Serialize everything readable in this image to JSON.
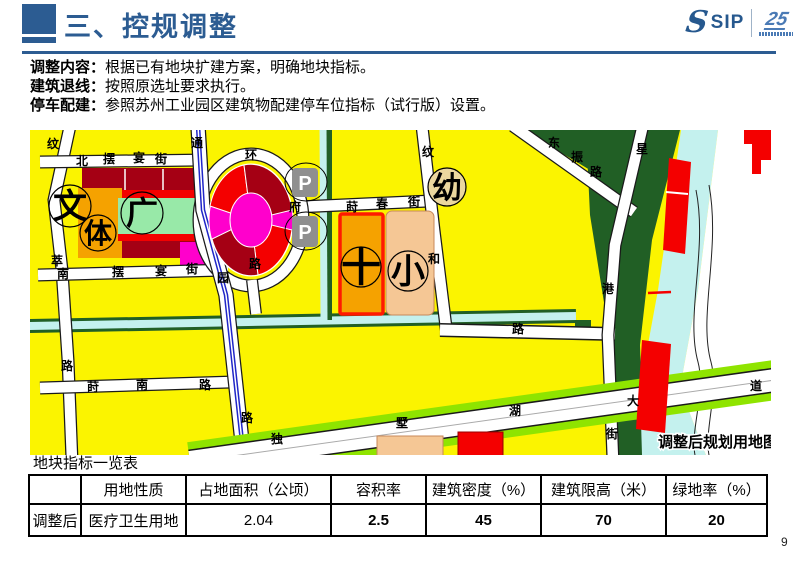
{
  "header": {
    "title": "三、控规调整",
    "logo_s": "S",
    "logo_sip": "SIP",
    "logo_anniv": "25"
  },
  "intro": [
    {
      "label": "调整内容：",
      "text": "根据已有地块扩建方案，明确地块指标。"
    },
    {
      "label": "建筑退线：",
      "text": "按照原选址要求执行。"
    },
    {
      "label": "停车配建：",
      "text": "参照苏州工业园区建筑物配建停车位指标（试行版）设置。"
    }
  ],
  "map": {
    "caption": "调整后规划用地图",
    "street_chars": [
      "纹",
      "北",
      "摆",
      "宴",
      "街",
      "通",
      "萃",
      "南",
      "摆",
      "宴",
      "街",
      "园",
      "路",
      "路",
      "环",
      "路",
      "府",
      "莳",
      "春",
      "街",
      "纹",
      "和",
      "路",
      "东",
      "振",
      "路",
      "星",
      "港",
      "街",
      "独",
      "墅",
      "湖",
      "大",
      "道",
      "莳",
      "南",
      "路"
    ],
    "markers": {
      "culture": "文",
      "sports": "体",
      "plaza": "广",
      "kindergarten": "幼",
      "school": "小",
      "hospital_cross": "十",
      "parking": "P"
    },
    "colors": {
      "residential_yellow": "#FBF400",
      "building_dark_red": "#A50014",
      "building_red": "#F40000",
      "magenta": "#FF00CC",
      "plaza_green": "#98E9A8",
      "orange": "#F5A200",
      "peach": "#F5C795",
      "water_cyan": "#C4F1EE",
      "forest_green": "#215F25",
      "light_green": "#8FE400",
      "road_blue": "#2026C8",
      "parking_gray": "#8F8F8F"
    }
  },
  "table": {
    "title": "地块指标一览表",
    "headers": [
      "",
      "用地性质",
      "占地面积（公顷）",
      "容积率",
      "建筑密度（%）",
      "建筑限高（米）",
      "绿地率（%）"
    ],
    "row_label": "调整后",
    "row_values": [
      "医疗卫生用地",
      "2.04",
      "2.5",
      "45",
      "70",
      "20"
    ]
  },
  "page_number": "9"
}
